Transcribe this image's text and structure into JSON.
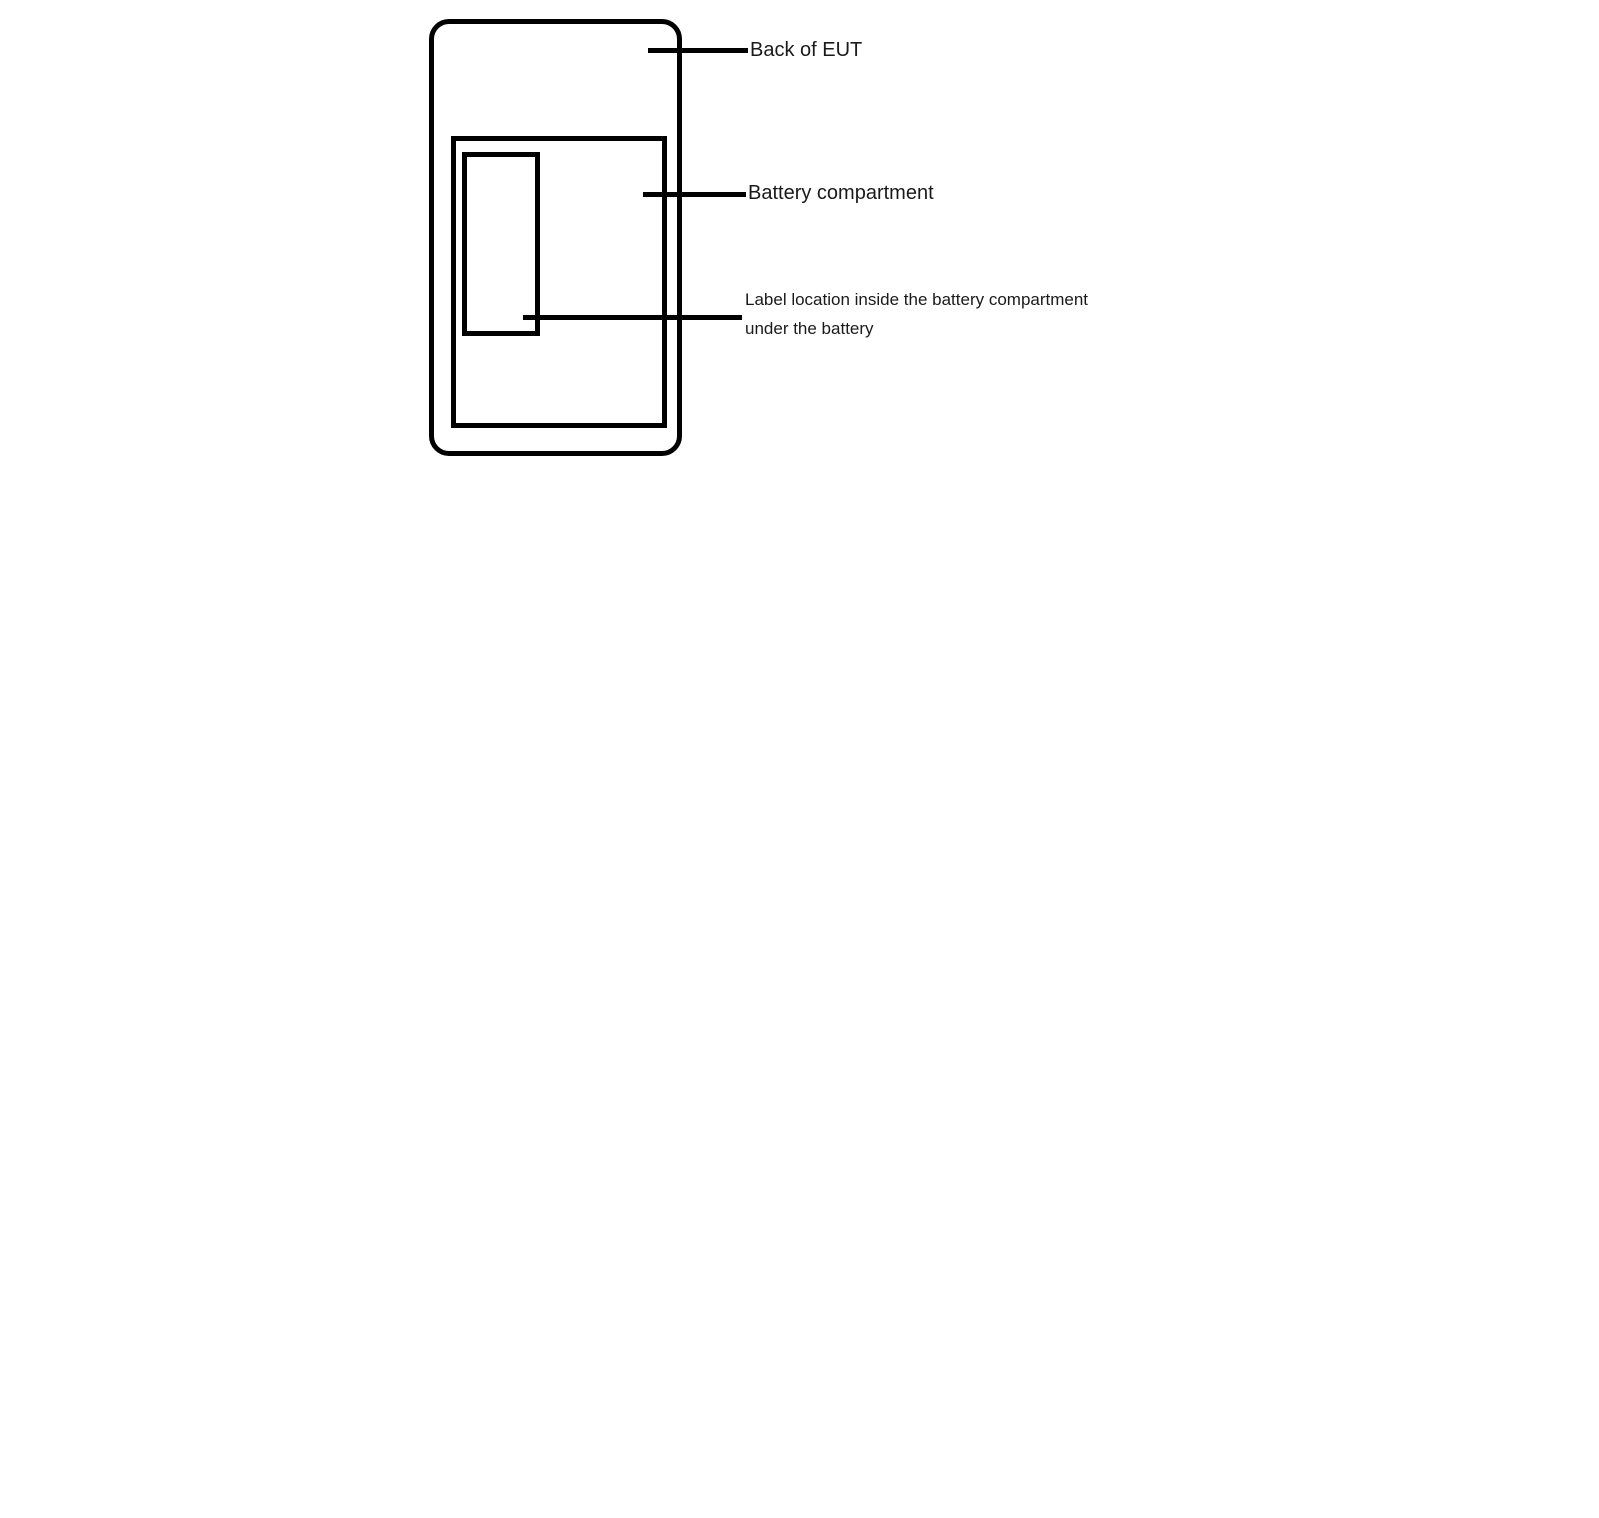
{
  "figure": {
    "annotations": {
      "back_of_eut": "Back of EUT",
      "battery_compartment": "Battery compartment",
      "label_location": {
        "line1": "Label location inside the battery compartment",
        "line2": "under the battery"
      }
    },
    "colors": {
      "stroke": "#000000",
      "text": "#1a1a1a",
      "background": "#ffffff"
    }
  }
}
